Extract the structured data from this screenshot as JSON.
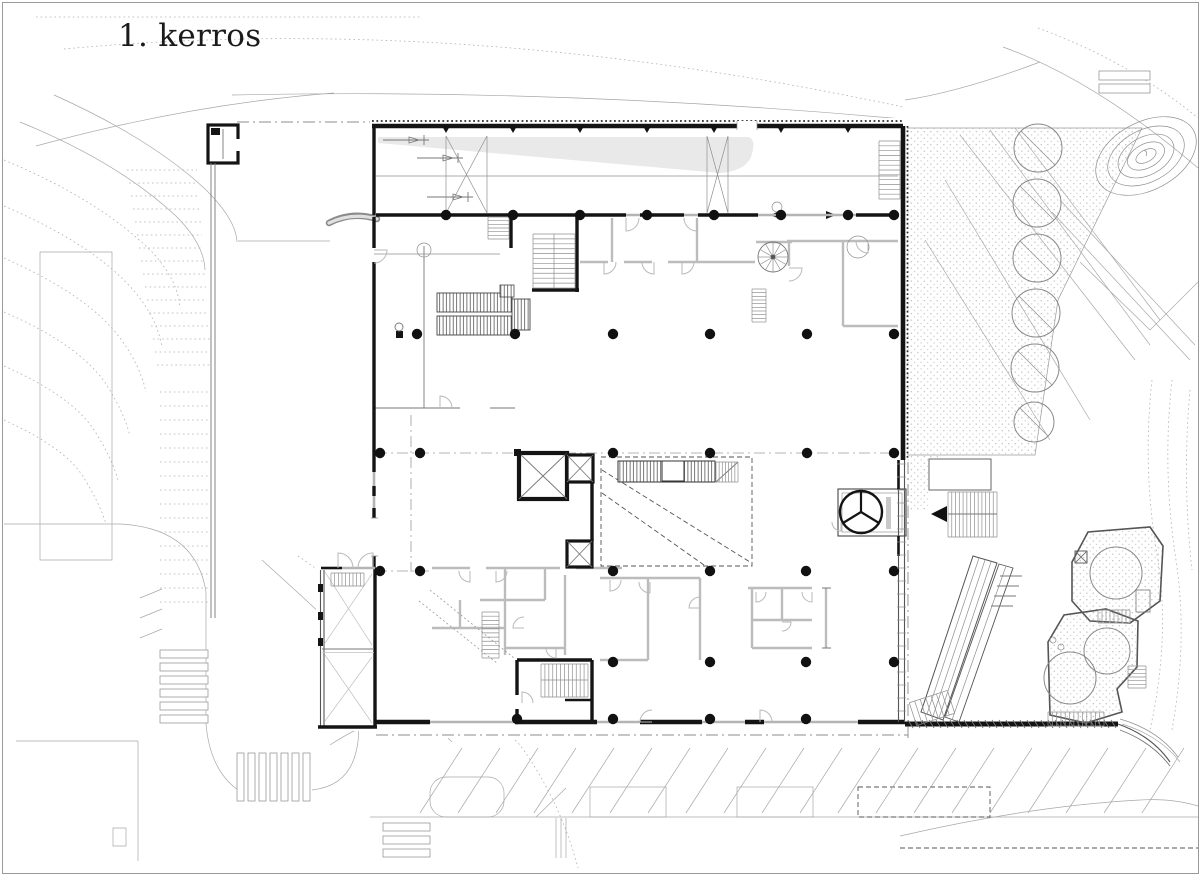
{
  "title": "1. kerros",
  "sheet": {
    "background": "#ffffff",
    "border_color": "#9a9a9a"
  },
  "palette": {
    "wall_black": "#141414",
    "partition_gray": "#bcbcbc",
    "site_line_gray": "#a8a8a8",
    "ramp_shade": "#e9e9e9",
    "stipple_dot": "#c6c6c6"
  },
  "features": [
    "loading-hall",
    "ramp-shade",
    "bicycle-symbols",
    "spiral-staircase",
    "straight-staircases",
    "elevator-shafts",
    "revolving-door-entrance",
    "entrance-arrow",
    "tree-row",
    "contour-mound",
    "pedestrian-crossings",
    "parking-stalls",
    "planters",
    "exterior-stair",
    "escalator-ramp",
    "retaining-wall",
    "column-grid"
  ]
}
